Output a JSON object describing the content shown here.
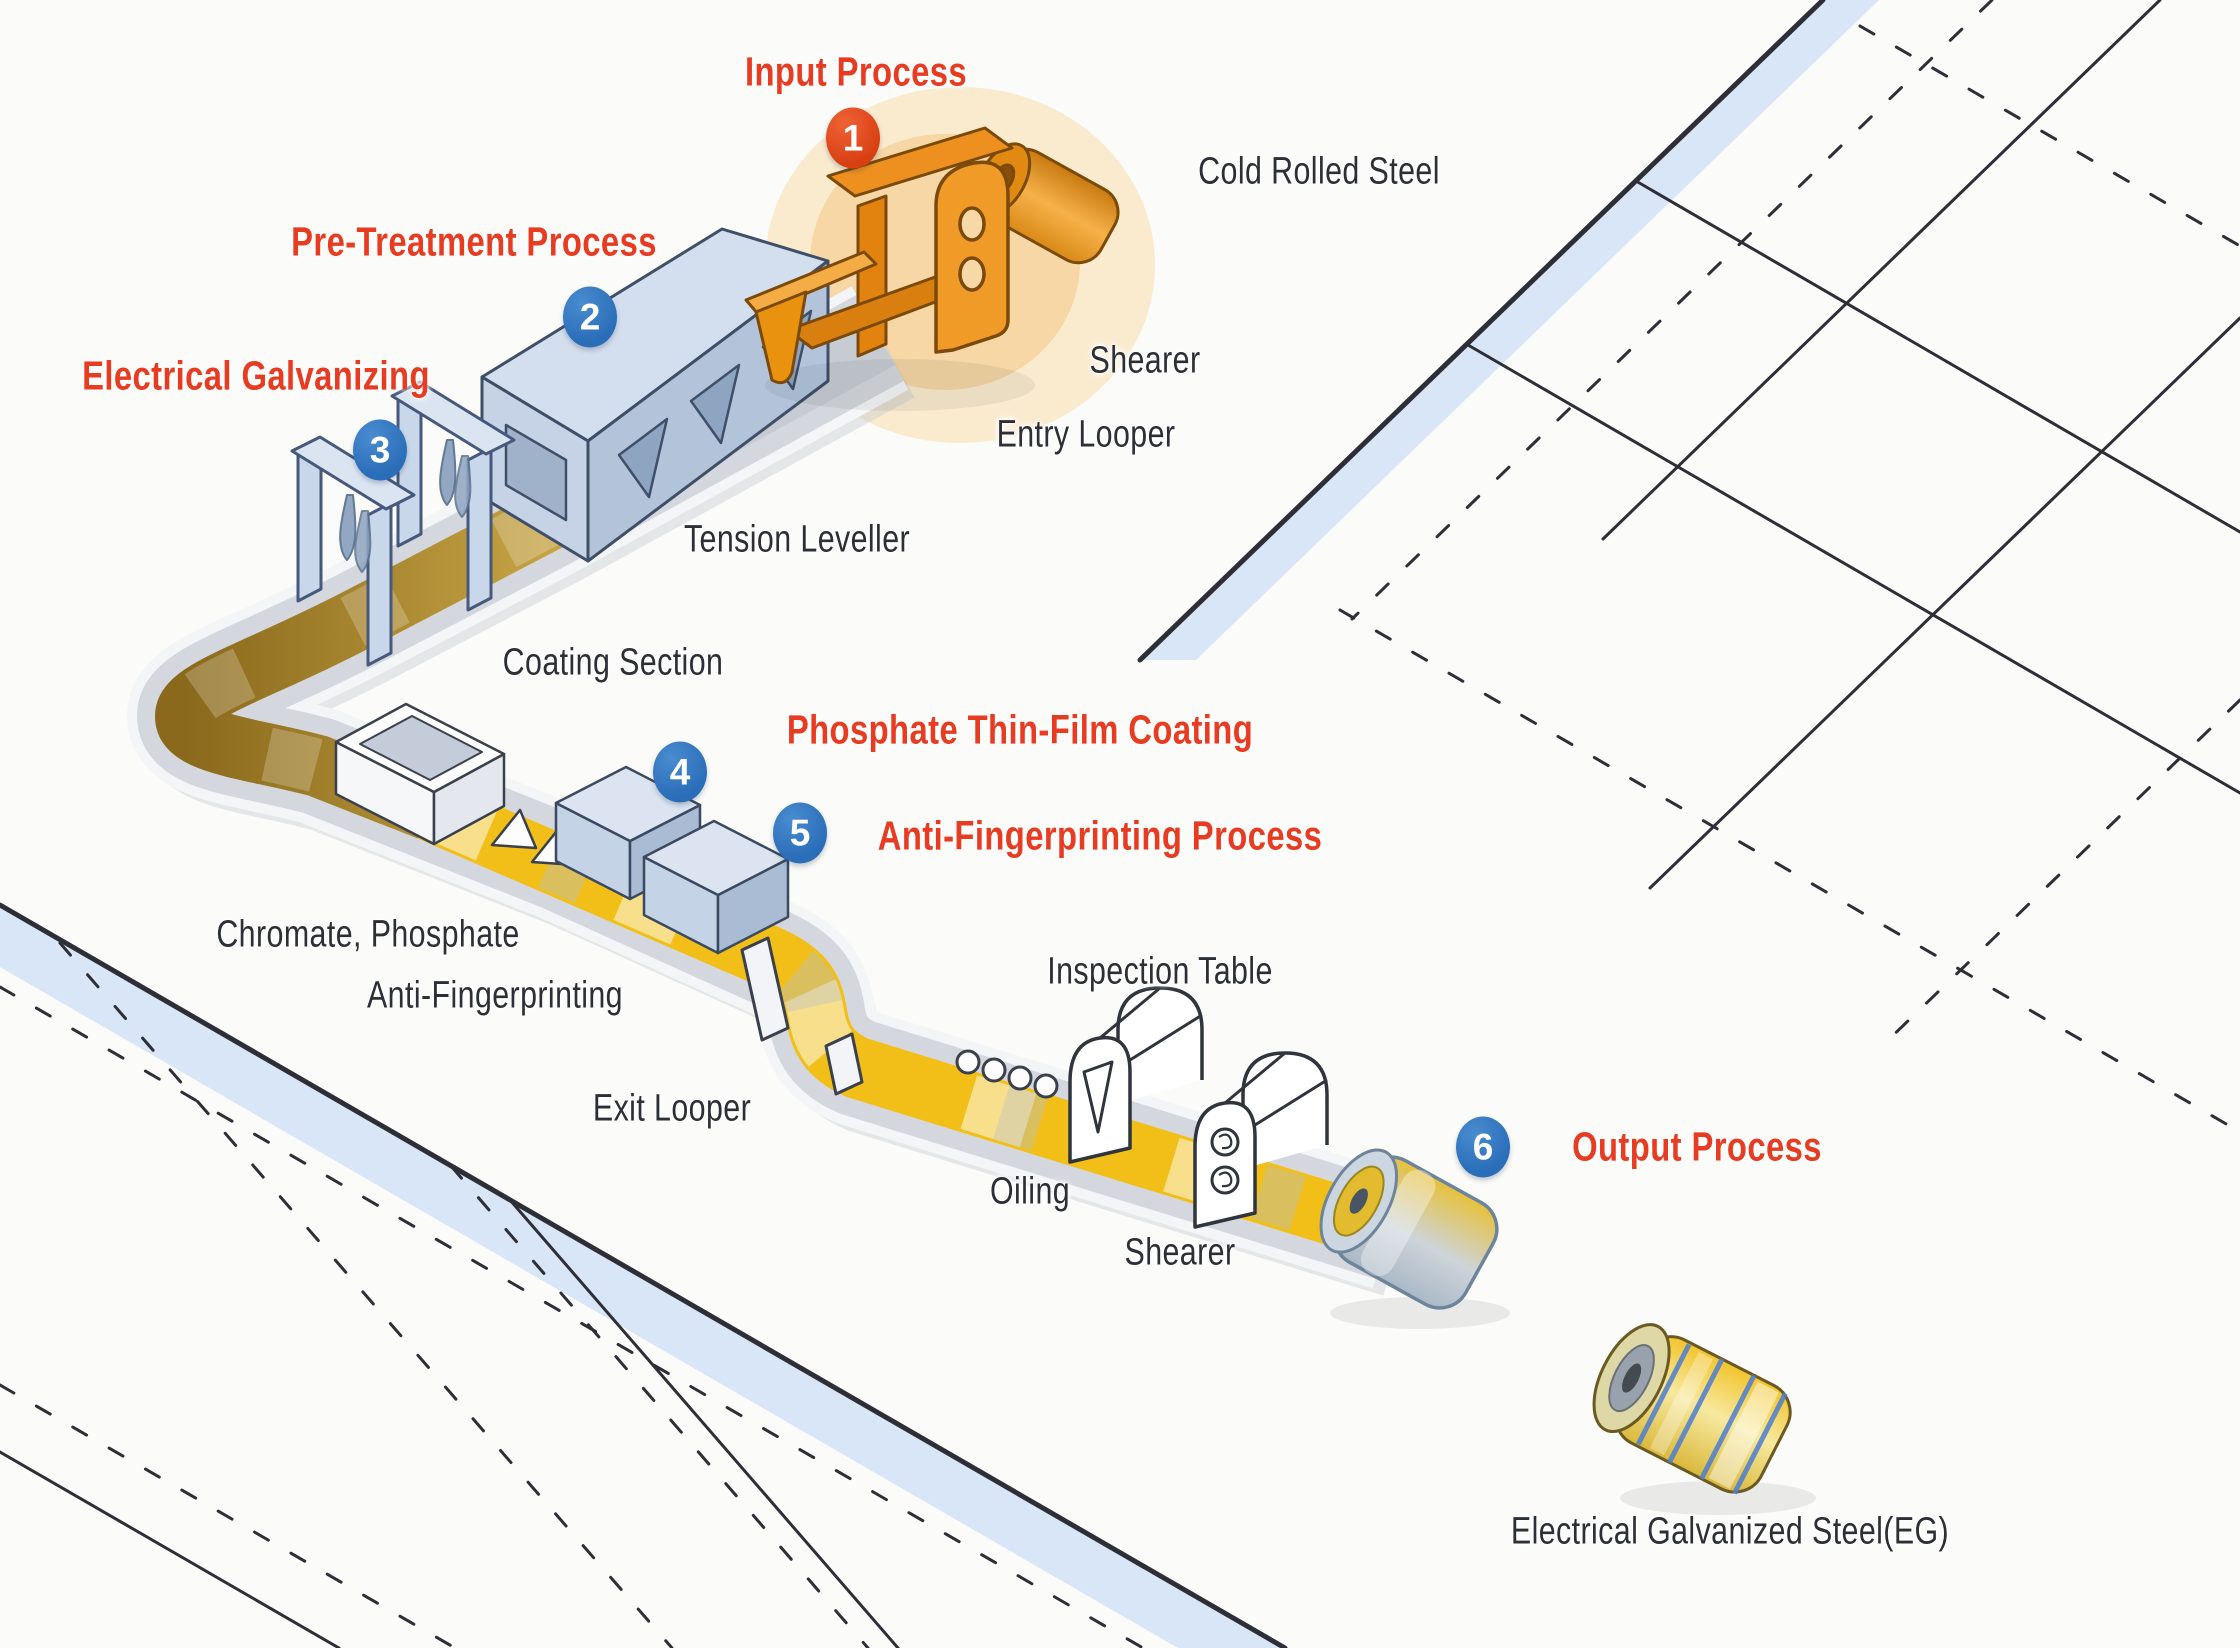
{
  "title": "Electrical Galvanizing Steel Production Process",
  "steps": [
    {
      "number": "1",
      "label": "Input Process"
    },
    {
      "number": "2",
      "label": "Pre-Treatment Process"
    },
    {
      "number": "3",
      "label": "Electrical Galvanizing"
    },
    {
      "number": "4",
      "label": "Phosphate Thin-Film Coating"
    },
    {
      "number": "5",
      "label": "Anti-Fingerprinting Process"
    },
    {
      "number": "6",
      "label": "Output Process"
    }
  ],
  "equipment_labels": [
    {
      "text": "Cold Rolled Steel"
    },
    {
      "text": "Shearer"
    },
    {
      "text": "Entry Looper"
    },
    {
      "text": "Tension Leveller"
    },
    {
      "text": "Coating Section"
    },
    {
      "text": "Chromate, Phosphate"
    },
    {
      "text": "Anti-Fingerprinting"
    },
    {
      "text": "Exit Looper"
    },
    {
      "text": "Inspection Table"
    },
    {
      "text": "Oiling"
    },
    {
      "text": "Shearer"
    },
    {
      "text": "Electrical Galvanized Steel(EG)"
    }
  ],
  "colors": {
    "step_heading": "#e73b22",
    "badge_blue": "#2a6db8",
    "badge_red": "#d84012",
    "belt_gold": "#f1bf17",
    "belt_pretreated": "#ad8528",
    "machine_blue": "#c2d1e4",
    "machine_orange": "#ef9321",
    "road_band": "#d9e6f8",
    "floor_line": "#2e2e36"
  }
}
